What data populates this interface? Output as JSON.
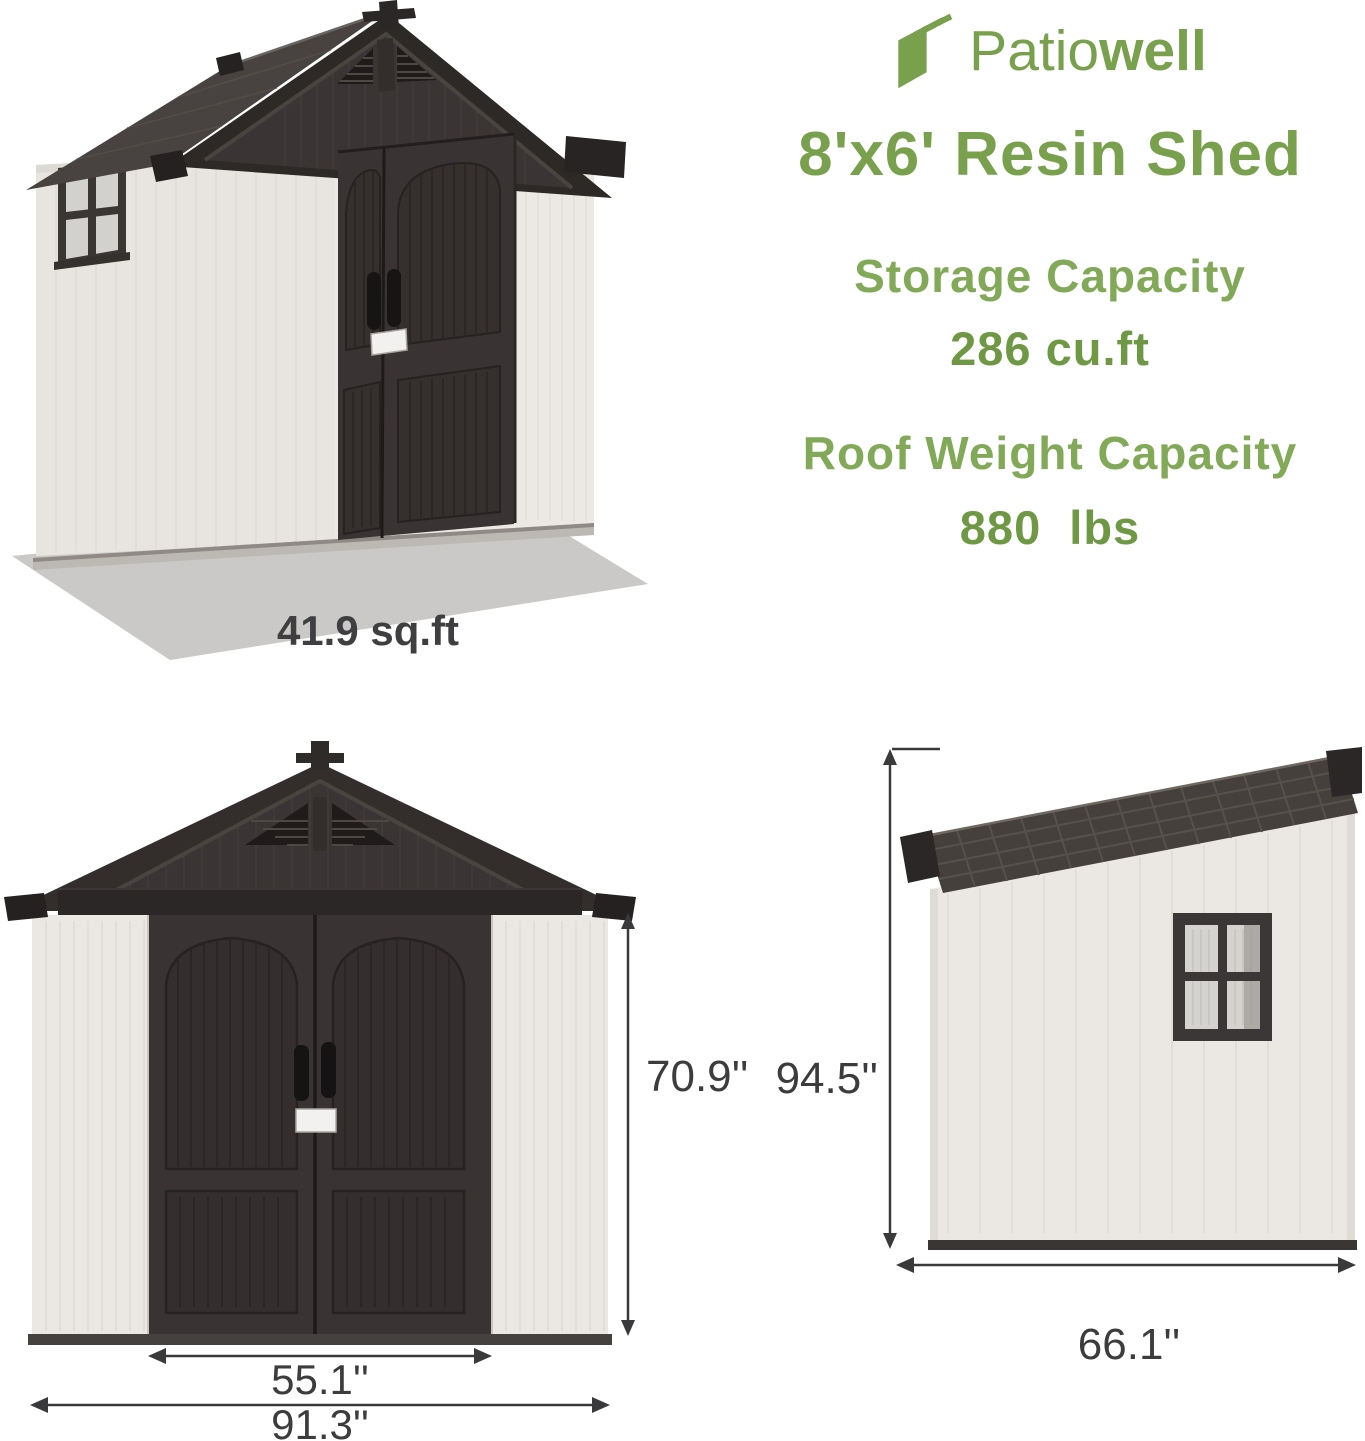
{
  "brand": {
    "name_regular": "Patio",
    "name_bold": "well",
    "logo_icon": "fanned-panels-icon"
  },
  "title": "8'x6' Resin Shed",
  "specs": [
    {
      "label": "Storage Capacity",
      "value": "286 cu.ft"
    },
    {
      "label": "Roof Weight Capacity",
      "value": "880 lbs"
    }
  ],
  "views": {
    "perspective": {
      "footprint": "41.9 sq.ft"
    },
    "front": {
      "height": "70.9''",
      "door_width": "55.1''",
      "overall_width": "91.3''"
    },
    "side": {
      "height": "94.5''",
      "width": "66.1''"
    }
  },
  "colors": {
    "brand_green": "#79a04c",
    "label_green": "#82a957",
    "value_green": "#6f9845",
    "dim_text": "#3c3c3e",
    "dim_line": "#3a3a3c",
    "wall_white": "#eae7e2",
    "door_dark": "#393433",
    "roof_dark": "#2d2927",
    "shadow_gray": "#cac9c7"
  }
}
